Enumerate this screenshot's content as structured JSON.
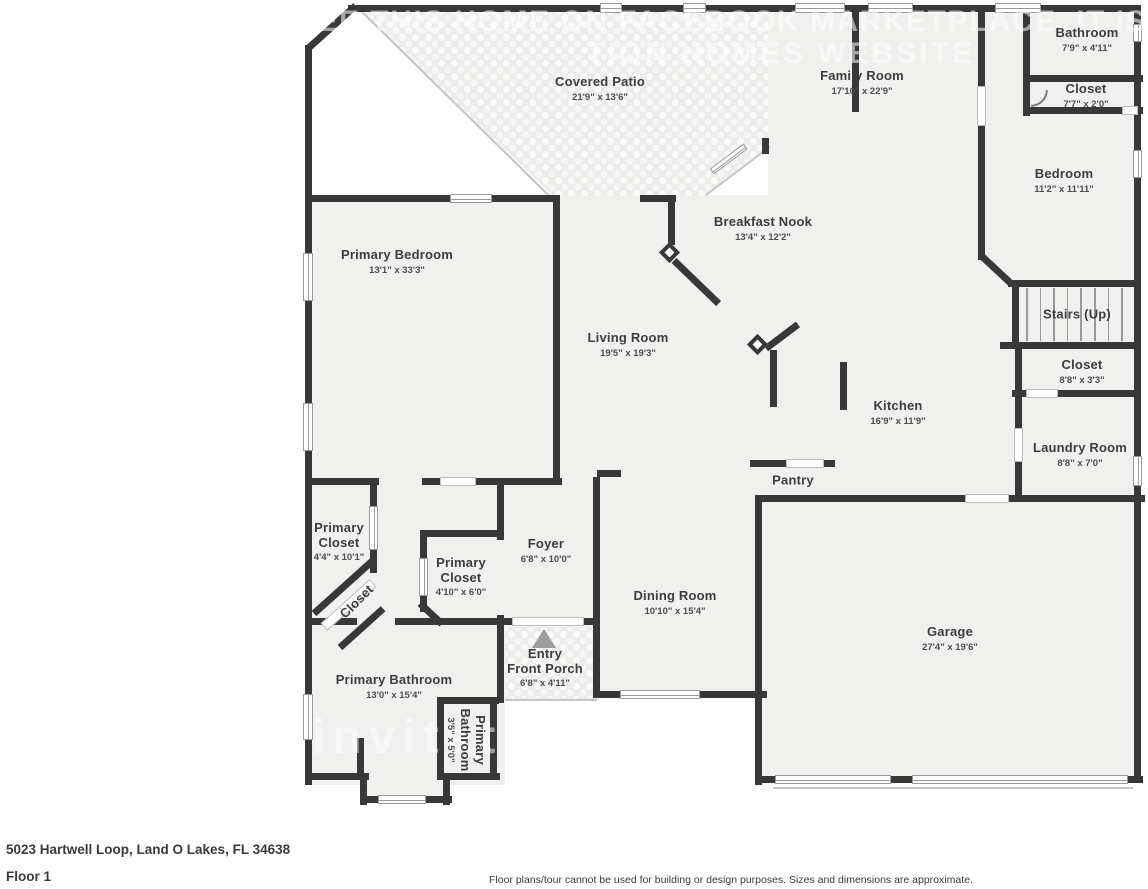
{
  "title": "Floor plan - Floor 1",
  "rooms": [
    {
      "id": "covered-patio",
      "name": "Covered Patio",
      "dims": "21'9\" x 13'6\""
    },
    {
      "id": "family-room",
      "name": "Family Room",
      "dims": "17'10\" x 22'9\""
    },
    {
      "id": "bathroom",
      "name": "Bathroom",
      "dims": "7'9\" x 4'11\""
    },
    {
      "id": "closet-top",
      "name": "Closet",
      "dims": "7'7\" x 2'0\""
    },
    {
      "id": "bedroom",
      "name": "Bedroom",
      "dims": "11'2\" x 11'11\""
    },
    {
      "id": "breakfast-nook",
      "name": "Breakfast Nook",
      "dims": "13'4\" x 12'2\""
    },
    {
      "id": "primary-bedroom",
      "name": "Primary Bedroom",
      "dims": "13'1\" x 33'3\""
    },
    {
      "id": "living-room",
      "name": "Living Room",
      "dims": "19'5\" x 19'3\""
    },
    {
      "id": "stairs",
      "name": "Stairs (Up)",
      "dims": ""
    },
    {
      "id": "closet-mid",
      "name": "Closet",
      "dims": "8'8\" x 3'3\""
    },
    {
      "id": "kitchen",
      "name": "Kitchen",
      "dims": "16'9\" x 11'9\""
    },
    {
      "id": "laundry-room",
      "name": "Laundry Room",
      "dims": "8'8\" x 7'0\""
    },
    {
      "id": "pantry",
      "name": "Pantry",
      "dims": ""
    },
    {
      "id": "primary-closet-1",
      "name": "Primary Closet",
      "dims": "4'4\" x 10'1\""
    },
    {
      "id": "closet-diagonal",
      "name": "Closet",
      "dims": ""
    },
    {
      "id": "primary-closet-2",
      "name": "Primary Closet",
      "dims": "4'10\" x 6'0\""
    },
    {
      "id": "foyer",
      "name": "Foyer",
      "dims": "6'8\" x 10'0\""
    },
    {
      "id": "entry",
      "name": "Entry",
      "name2": "Front Porch",
      "dims": "6'8\" x 4'11\""
    },
    {
      "id": "dining-room",
      "name": "Dining Room",
      "dims": "10'10\" x 15'4\""
    },
    {
      "id": "garage",
      "name": "Garage",
      "dims": "27'4\" x 19'6\""
    },
    {
      "id": "primary-bathroom",
      "name": "Primary Bathroom",
      "dims": "13'0\" x 15'4\""
    },
    {
      "id": "primary-bathroom-small",
      "name": "Primary Bathroom",
      "dims": "3'5\" x 5'0\""
    }
  ],
  "watermark": {
    "top_line1": "SEE THIS HOME ON FACEBOOK MARKETPLACE, IT IS",
    "top_line2": "TION HOMES WEBSITE",
    "bottom": "invitatio"
  },
  "footer": {
    "address": "5023 Hartwell Loop, Land O Lakes, FL 34638",
    "floor": "Floor 1",
    "disclaimer": "Floor plans/tour cannot be used for building or design purposes. Sizes and dimensions are approximate."
  },
  "colors": {
    "wall": "#383838",
    "room_fill": "#f0f0ef",
    "entry_arrow": "#9c9c9c"
  }
}
